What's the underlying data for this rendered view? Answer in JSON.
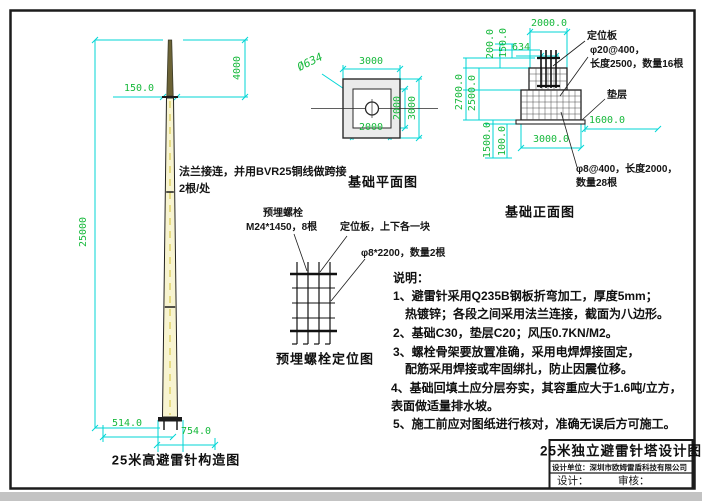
{
  "colors": {
    "dim_line": "#00d6d6",
    "dim_text": "#17b93c",
    "ink": "#1c1c1c",
    "pole_fill": "#f8f4d0",
    "pole_dash": "#e6db84",
    "needle_fill": "#6c6336"
  },
  "pole_view": {
    "title": "25米高避雷针构造图",
    "note_line1": "法兰接连，并用BVR25铜线做跨接",
    "note_line2": "2根/处",
    "dim_total": "25000",
    "dim_needle": "4000",
    "dim_top": "150.0",
    "dim_base": "514.0",
    "dim_flange": "754.0"
  },
  "plan_view": {
    "title": "基础平面图",
    "dim_outer_top": "3000",
    "dim_outer_right": "3000",
    "dim_inner_bottom": "2000",
    "dim_inner_right": "2000",
    "dim_diameter": "Ø634"
  },
  "front_view": {
    "title": "基础正面图",
    "dim_top": "2000.0",
    "dim_634": "634",
    "dim_150": "150.0",
    "dim_200": "200.0",
    "dim_2700": "2700.0",
    "dim_2500": "2500.0",
    "dim_1500": "1500.0",
    "dim_100": "100.0",
    "dim_1600": "1600.0",
    "dim_3000": "3000.0",
    "label_plate": "定位板",
    "label_rebar_v1": "φ20@400，",
    "label_rebar_v2": "长度2500，数量16根",
    "label_cushion": "垫层",
    "label_rebar_h1": "φ8@400，长度2000，",
    "label_rebar_h2": "数量28根"
  },
  "bolt_view": {
    "title": "预埋螺栓定位图",
    "label_bolt1": "预埋螺栓",
    "label_bolt2": "M24*1450，8根",
    "label_plate": "定位板，上下各一块",
    "label_hoop": "φ8*2200，数量2根"
  },
  "notes": {
    "heading": "说明：",
    "line1": "1、避雷针采用Q235B钢板折弯加工，厚度5mm；",
    "line2": "热镀锌；各段之间采用法兰连接，截面为八边形。",
    "line3": "2、基础C30，垫层C20；风压0.7KN/M2。",
    "line4": "3、螺栓骨架要放置准确，采用电焊焊接固定，",
    "line5": "配筋采用焊接或牢固绑扎，防止因震位移。",
    "line6": "4、基础回填土应分层夯实，其容重应大于1.6吨/立方，",
    "line7": "表面做适量排水坡。",
    "line8": "5、施工前应对图纸进行核对，准确无误后方可施工。"
  },
  "title_block": {
    "drawing_title": "25米独立避雷针塔设计图",
    "company": "设计单位：深圳市欧姆雷盾科技有限公司",
    "designer": "设计：",
    "reviewer": "审核："
  }
}
